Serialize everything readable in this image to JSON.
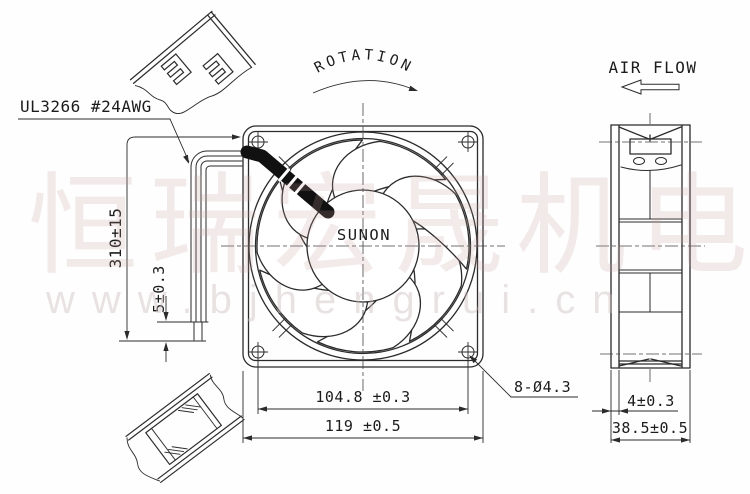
{
  "colors": {
    "line": "#2b2b2b",
    "watermark_cn": "#c59898",
    "watermark_url": "#cdbcbc"
  },
  "labels": {
    "rotation": "ROTATION",
    "air_flow": "AIR FLOW",
    "wire_spec": "UL3266 #24AWG",
    "brand": "SUNON"
  },
  "dimensions": {
    "lead_wire_length": "310±15",
    "strip_length": "5±0.3",
    "hole_pitch": "104.8 ±0.3",
    "frame_size": "119 ±0.5",
    "mounting_holes": "8-Ø4.3",
    "flange_thickness": "4±0.3",
    "frame_depth": "38.5±0.5"
  },
  "watermark": {
    "cn": "恒瑞宏晟机电",
    "url": "www.bjhengrui.cn"
  }
}
